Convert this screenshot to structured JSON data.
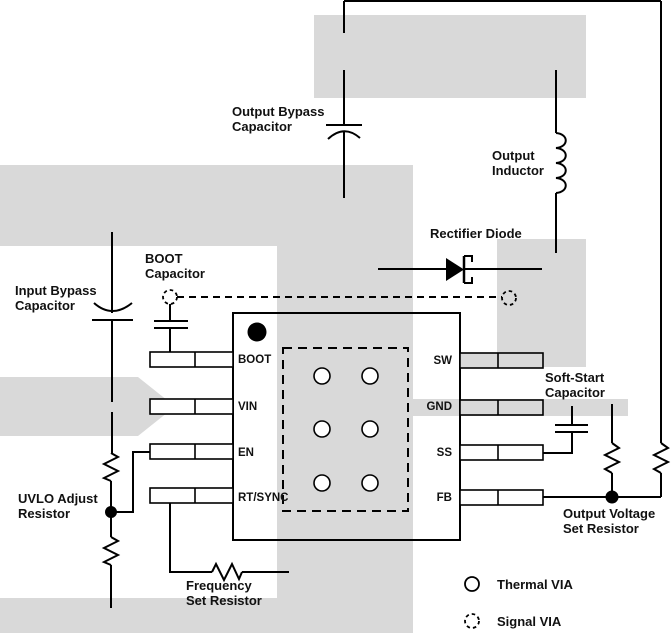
{
  "figure": {
    "type": "pcb-layout-diagram",
    "copper_color": "#d9d9d9",
    "line_color": "#000000",
    "text_color": "#111111",
    "background": "#ffffff"
  },
  "labels": {
    "output_bypass_capacitor": {
      "line1": "Output Bypass",
      "line2": "Capacitor"
    },
    "output_inductor": {
      "line1": "Output",
      "line2": "Inductor"
    },
    "rectifier_diode": {
      "line1": "Rectifier Diode"
    },
    "boot_capacitor": {
      "line1": "BOOT",
      "line2": "Capacitor"
    },
    "input_bypass_capacitor": {
      "line1": "Input Bypass",
      "line2": "Capacitor"
    },
    "soft_start_capacitor": {
      "line1": "Soft-Start",
      "line2": "Capacitor"
    },
    "uvlo_adjust_resistor": {
      "line1": "UVLO Adjust",
      "line2": "Resistor"
    },
    "output_voltage_set_resistor": {
      "line1": "Output Voltage",
      "line2": "Set Resistor"
    },
    "frequency_set_resistor": {
      "line1": "Frequency",
      "line2": "Set Resistor"
    }
  },
  "ic": {
    "pins_left": [
      "BOOT",
      "VIN",
      "EN",
      "RT/SYNC"
    ],
    "pins_right": [
      "SW",
      "GND",
      "SS",
      "FB"
    ]
  },
  "legend": {
    "thermal_via": "Thermal VIA",
    "signal_via": "Signal VIA"
  }
}
